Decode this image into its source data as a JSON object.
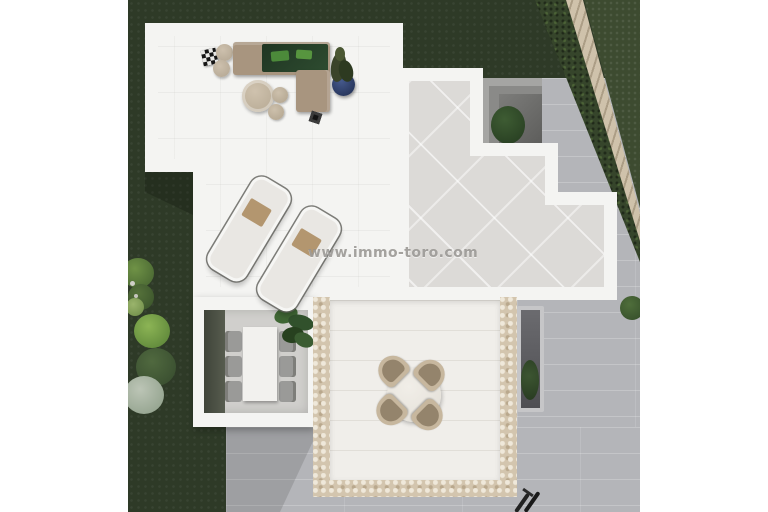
{
  "watermark": {
    "text": "www.immo-toro.com"
  },
  "palette": {
    "lawn_dark": "#2e3a27",
    "lawn_light": "#3d4b30",
    "pavement_grey": "#b4b5b9",
    "wall_white": "#f4f4f2",
    "terrace_tile": "#dcdad7",
    "mosaic_border": "#d3c5ae",
    "sofa_taupe": "#a8957f",
    "cushion_dark_green": "#243c26",
    "cushion_bright_green": "#4c8a3a",
    "towel_tan": "#b3966f",
    "plant_pot_blue": "#2e3f66"
  },
  "scene": {
    "description": "Top-down 3D architect render of a villa terrace and garden",
    "areas": [
      "lounge roof terrace",
      "tiled upper terrace",
      "sunken patio with tree",
      "indoor dining room",
      "outdoor dining platform with mosaic border",
      "garden lawn with shrubs",
      "diagonal stone boundary path",
      "grey paved walkway"
    ]
  }
}
